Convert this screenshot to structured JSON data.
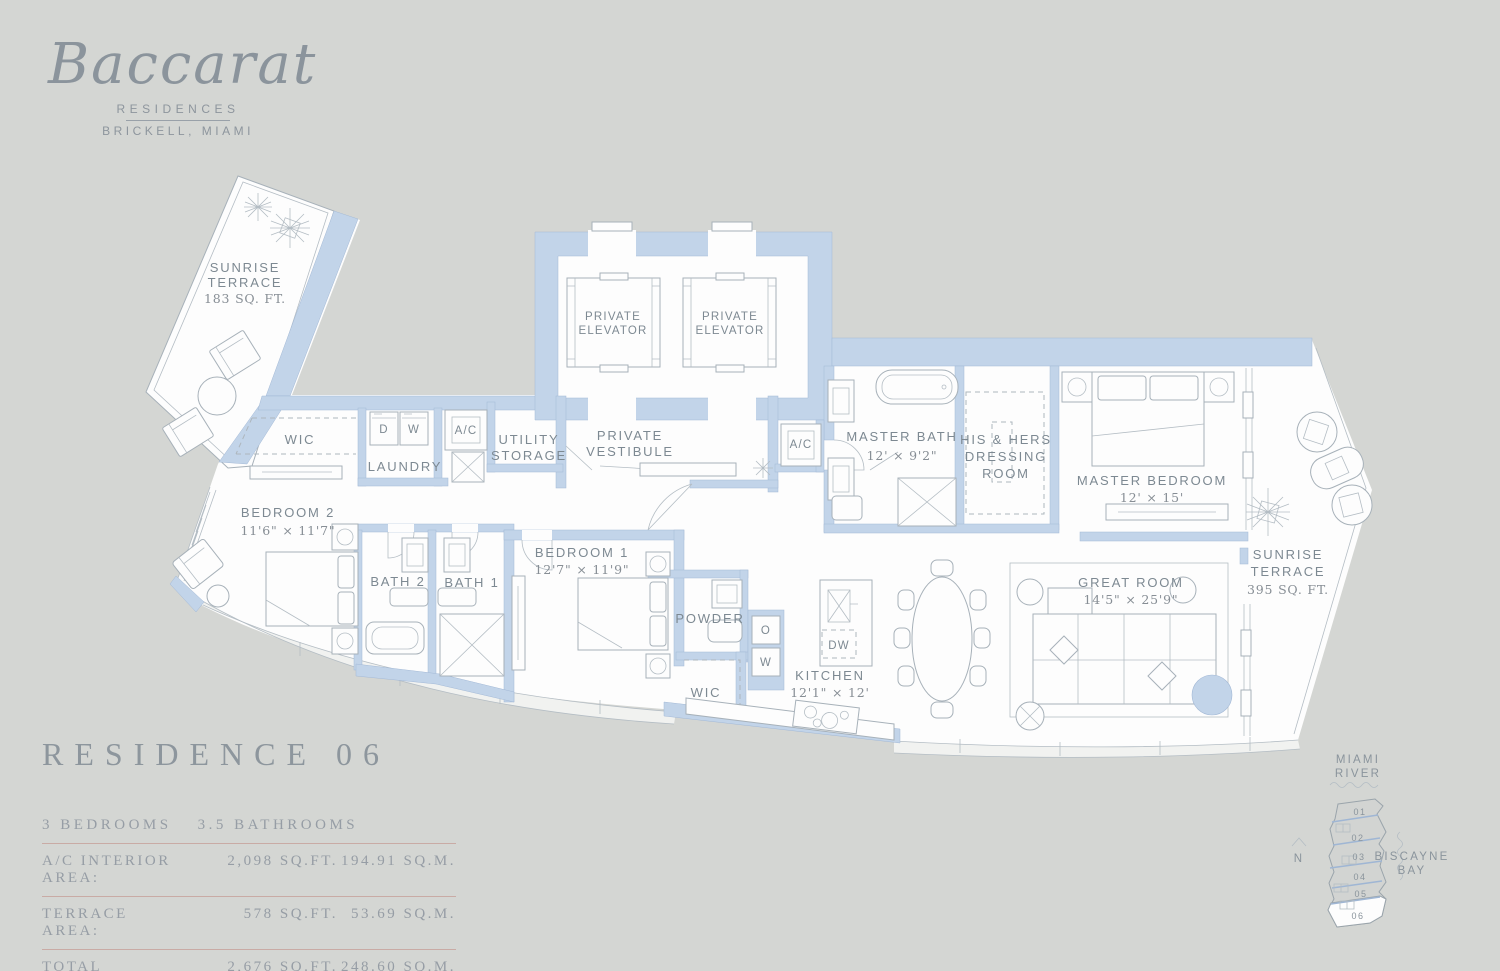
{
  "logo": {
    "brand": "Baccarat",
    "residences": "RESIDENCES",
    "location": "BRICKELL, MIAMI"
  },
  "plan": {
    "terrace_nw": {
      "l1": "SUNRISE",
      "l2": "TERRACE",
      "area": "183 SQ. FT."
    },
    "elevator1": {
      "l1": "PRIVATE",
      "l2": "ELEVATOR"
    },
    "elevator2": {
      "l1": "PRIVATE",
      "l2": "ELEVATOR"
    },
    "vestibule": {
      "l1": "PRIVATE",
      "l2": "VESTIBULE"
    },
    "utility": {
      "l1": "UTILITY",
      "l2": "STORAGE"
    },
    "laundry": "LAUNDRY",
    "dryer": "D",
    "washer": "W",
    "ac1": "A/C",
    "ac2": "A/C",
    "wic1": "WIC",
    "wic2": "WIC",
    "master_bath": {
      "name": "MASTER BATH",
      "dims": "12' × 9'2\""
    },
    "dressing": {
      "l1": "HIS & HERS",
      "l2": "DRESSING",
      "l3": "ROOM"
    },
    "master_bedroom": {
      "name": "MASTER BEDROOM",
      "dims": "12' × 15'"
    },
    "terrace_e": {
      "l1": "SUNRISE",
      "l2": "TERRACE",
      "area": "395 SQ. FT."
    },
    "bedroom2": {
      "name": "BEDROOM 2",
      "dims": "11'6\" × 11'7\""
    },
    "bath2": "BATH 2",
    "bath1": "BATH 1",
    "bedroom1": {
      "name": "BEDROOM 1",
      "dims": "12'7\" × 11'9\""
    },
    "powder": "POWDER",
    "oven": "O",
    "wine": "W",
    "dishwasher": "DW",
    "kitchen": {
      "name": "KITCHEN",
      "dims": "12'1\" × 12'"
    },
    "great_room": {
      "name": "GREAT ROOM",
      "dims": "14'5\" × 25'9\""
    }
  },
  "info": {
    "title": "RESIDENCE 06",
    "bedrooms": "3 BEDROOMS",
    "bathrooms": "3.5 BATHROOMS",
    "rows": [
      {
        "label": "A/C INTERIOR AREA:",
        "sqft": "2,098 SQ.FT.",
        "sqm": "194.91 SQ.M."
      },
      {
        "label": "TERRACE AREA:",
        "sqft": "578 SQ.FT.",
        "sqm": "53.69 SQ.M."
      },
      {
        "label": "TOTAL RESIDENCE:",
        "sqft": "2,676 SQ.FT.",
        "sqm": "248.60 SQ.M."
      }
    ]
  },
  "keyplan": {
    "river_l1": "MIAMI",
    "river_l2": "RIVER",
    "bay_l1": "BISCAYNE",
    "bay_l2": "BAY",
    "north": "N",
    "units": [
      "01",
      "02",
      "03",
      "04",
      "05",
      "06"
    ],
    "highlighted_unit": "06"
  },
  "colors": {
    "wall": "#c2d4e9",
    "background": "#d4d6d3",
    "table_rule": "#c9aba5"
  }
}
